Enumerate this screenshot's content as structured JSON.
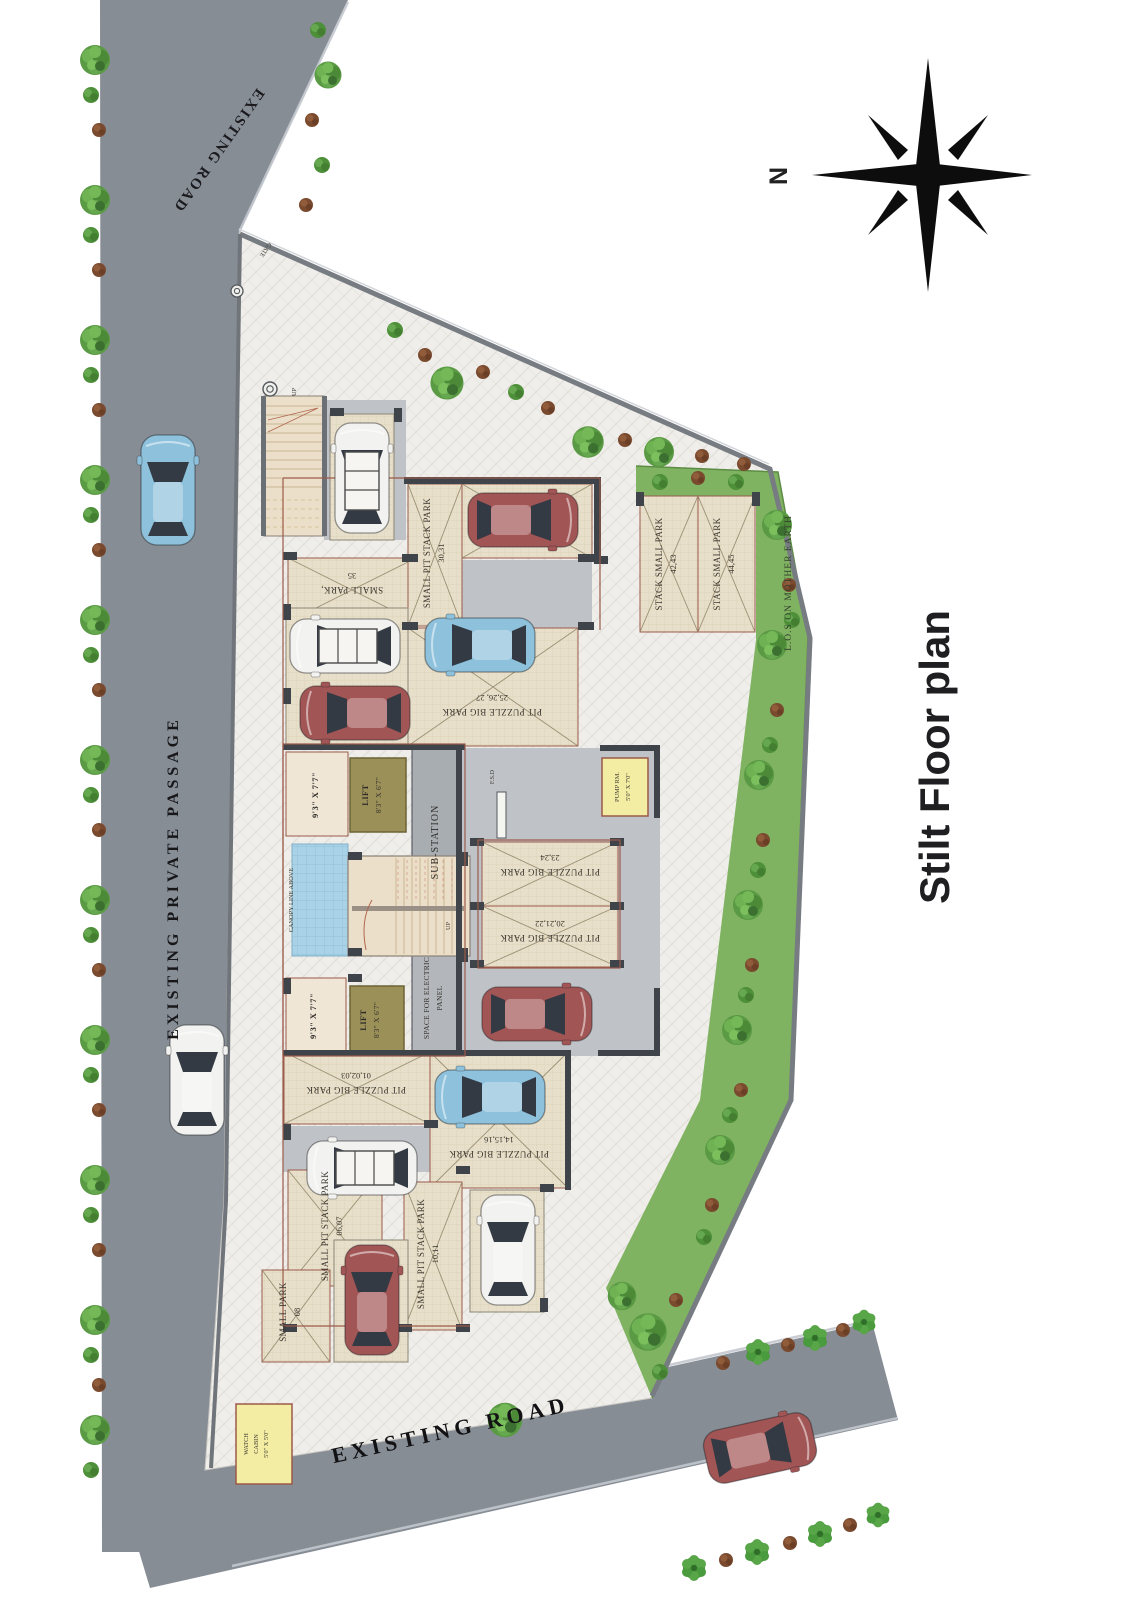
{
  "title": "Stilt Floor plan",
  "compass": {
    "north": "N"
  },
  "roads": {
    "top": "EXISTING ROAD",
    "left": "EXISTING  PRIVATE  PASSAGE",
    "bottom": "EXISTING  ROAD"
  },
  "site": {
    "lawn": "L.O.S ON MOTHER EARTH",
    "gate": "GATE",
    "fsd": "F.S.D",
    "canopy": "CANOPY LINE ABOVE",
    "up": "UP"
  },
  "rooms": {
    "lift_name": "LIFT",
    "lift_size": "8'3\" X 6'7\"",
    "lobby_size": "9'3\" X 7'7\"",
    "substation": "SUB-STATION",
    "electric_line1": "SPACE FOR ELECTRIC",
    "electric_line2": "PANEL",
    "pump_name": "PUMP RM.",
    "pump_size": "5'0\" X 7'0\"",
    "watch_line1": "WATCH",
    "watch_line2": "CABIN",
    "watch_size": "5'0\" X 5'0\""
  },
  "stalls": [
    {
      "label": "SMALL PARK,",
      "numbers": "35"
    },
    {
      "label": "SMALL PIT STACK PARK",
      "numbers": "30,31"
    },
    {
      "label": "STACK SMALL PARK",
      "numbers": "42,43"
    },
    {
      "label": "STACK SMALL PARK",
      "numbers": "44,45"
    },
    {
      "label": "PIT PUZZLE BIG PARK",
      "numbers": "25,26, 27"
    },
    {
      "label": "PIT PUZZLE BIG PARK",
      "numbers": "23,24"
    },
    {
      "label": "PIT PUZZLE BIG PARK",
      "numbers": "20,21,22"
    },
    {
      "label": "PIT PUZZLE BIG PARK",
      "numbers": "01,02,03"
    },
    {
      "label": "PIT PUZZLE BIG PARK",
      "numbers": "14,15,16"
    },
    {
      "label": "SMALL PIT STACK PARK",
      "numbers": "06,07"
    },
    {
      "label": "SMALL PIT STACK PARK",
      "numbers": "10,11"
    },
    {
      "label": "SMALL PARK",
      "numbers": "08"
    }
  ],
  "colors": {
    "road": "#878d95",
    "lawn": "#7fb261",
    "paving": "#efeeea",
    "stall_beige": "#e7dfc9",
    "lift_olive": "#9c9059",
    "pool_blue": "#a9d2e6",
    "utility_yellow": "#f3eda4",
    "wall_dark": "#3f444a",
    "outline_red": "#9b5a4a"
  }
}
